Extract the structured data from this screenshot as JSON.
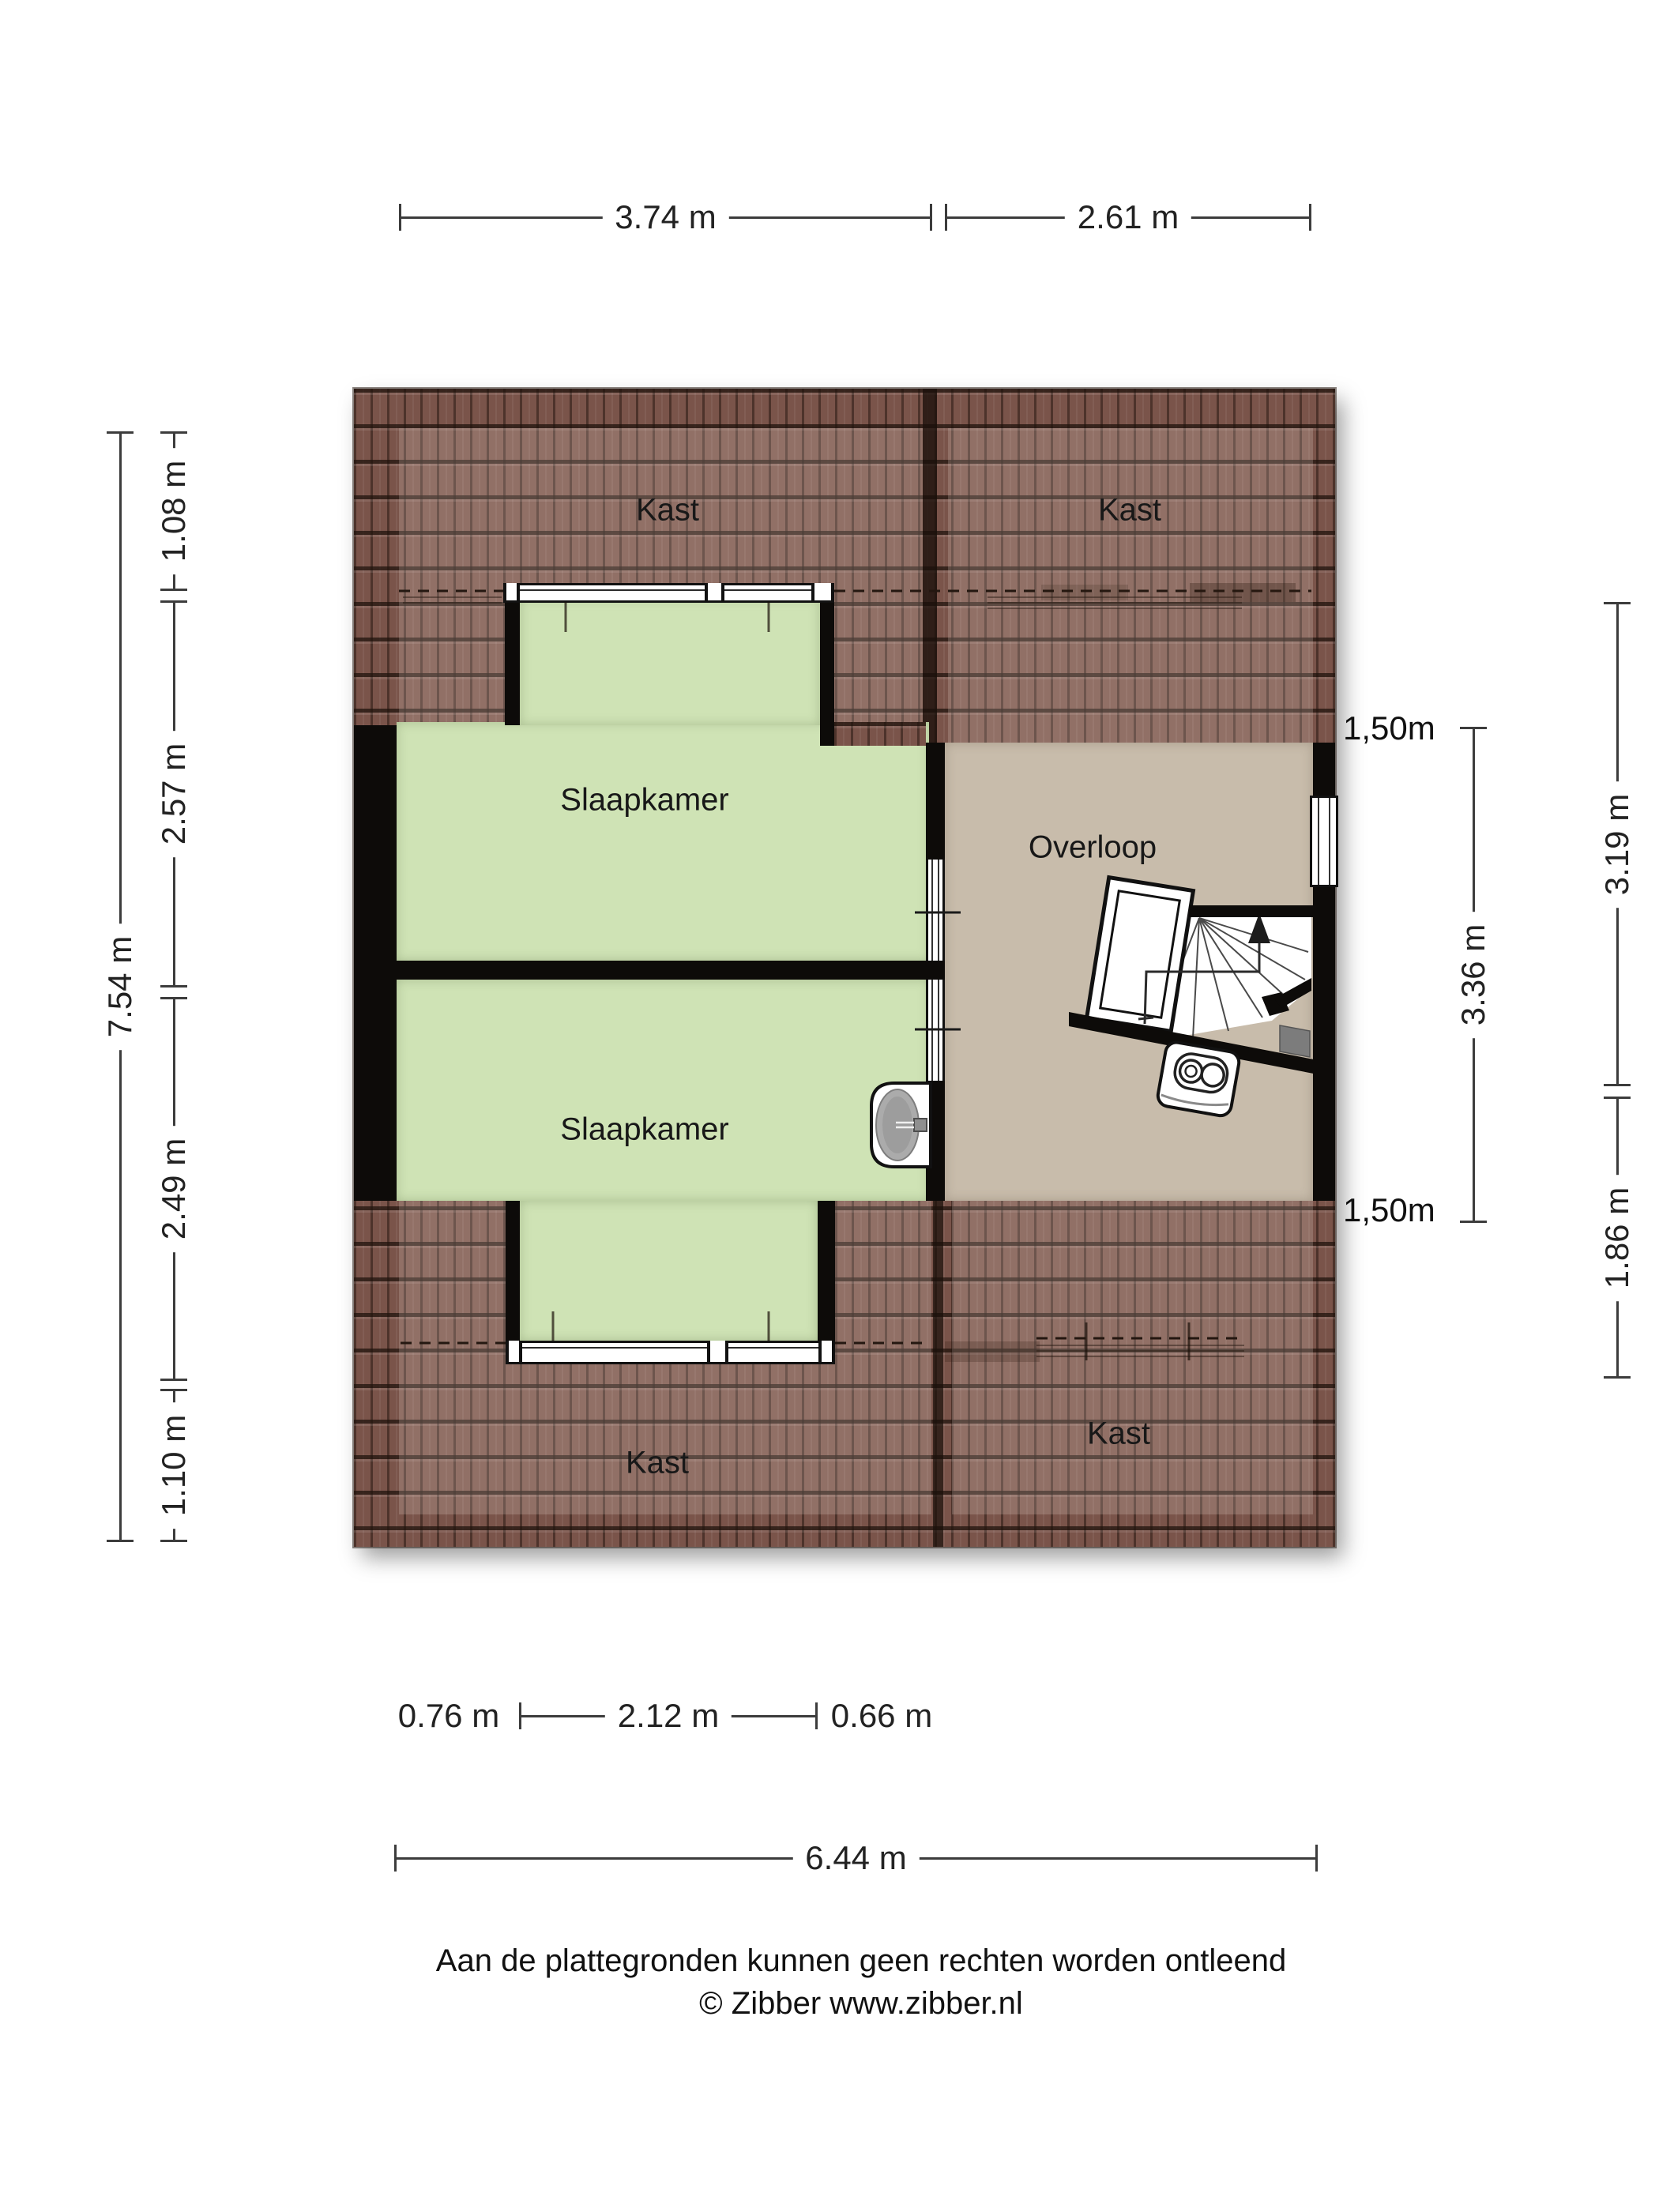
{
  "plan_title": "Attic floor plan",
  "rooms": {
    "kast_top_left": "Kast",
    "kast_top_right": "Kast",
    "slaapkamer_top": "Slaapkamer",
    "slaapkamer_bottom": "Slaapkamer",
    "overloop": "Overloop",
    "kast_bottom_left": "Kast",
    "kast_bottom_right": "Kast"
  },
  "annotations": {
    "knee_wall_top": "1,50m",
    "knee_wall_bottom": "1,50m"
  },
  "dimensions": {
    "top": [
      "3.74 m",
      "2.61 m"
    ],
    "left_outer": "7.54 m",
    "left_inner": [
      "1.08 m",
      "2.57 m",
      "2.49 m",
      "1.10 m"
    ],
    "right_inner": "3.36 m",
    "right_outer": [
      "3.19 m",
      "1.86 m"
    ],
    "bottom": [
      "0.76 m",
      "2.12 m",
      "0.66 m"
    ],
    "bottom_total": "6.44 m"
  },
  "footer": {
    "line1": "Aan de plattegronden kunnen geen rechten worden ontleend",
    "line2": "© Zibber www.zibber.nl"
  },
  "colors": {
    "roof": "#7a544a",
    "roof_joint": "#2e1d16",
    "bedroom_green": "#cfe3b5",
    "landing_tan": "#c8bcab",
    "wall_black": "#0d0b09",
    "dimension_gray": "#3c3c3c"
  }
}
